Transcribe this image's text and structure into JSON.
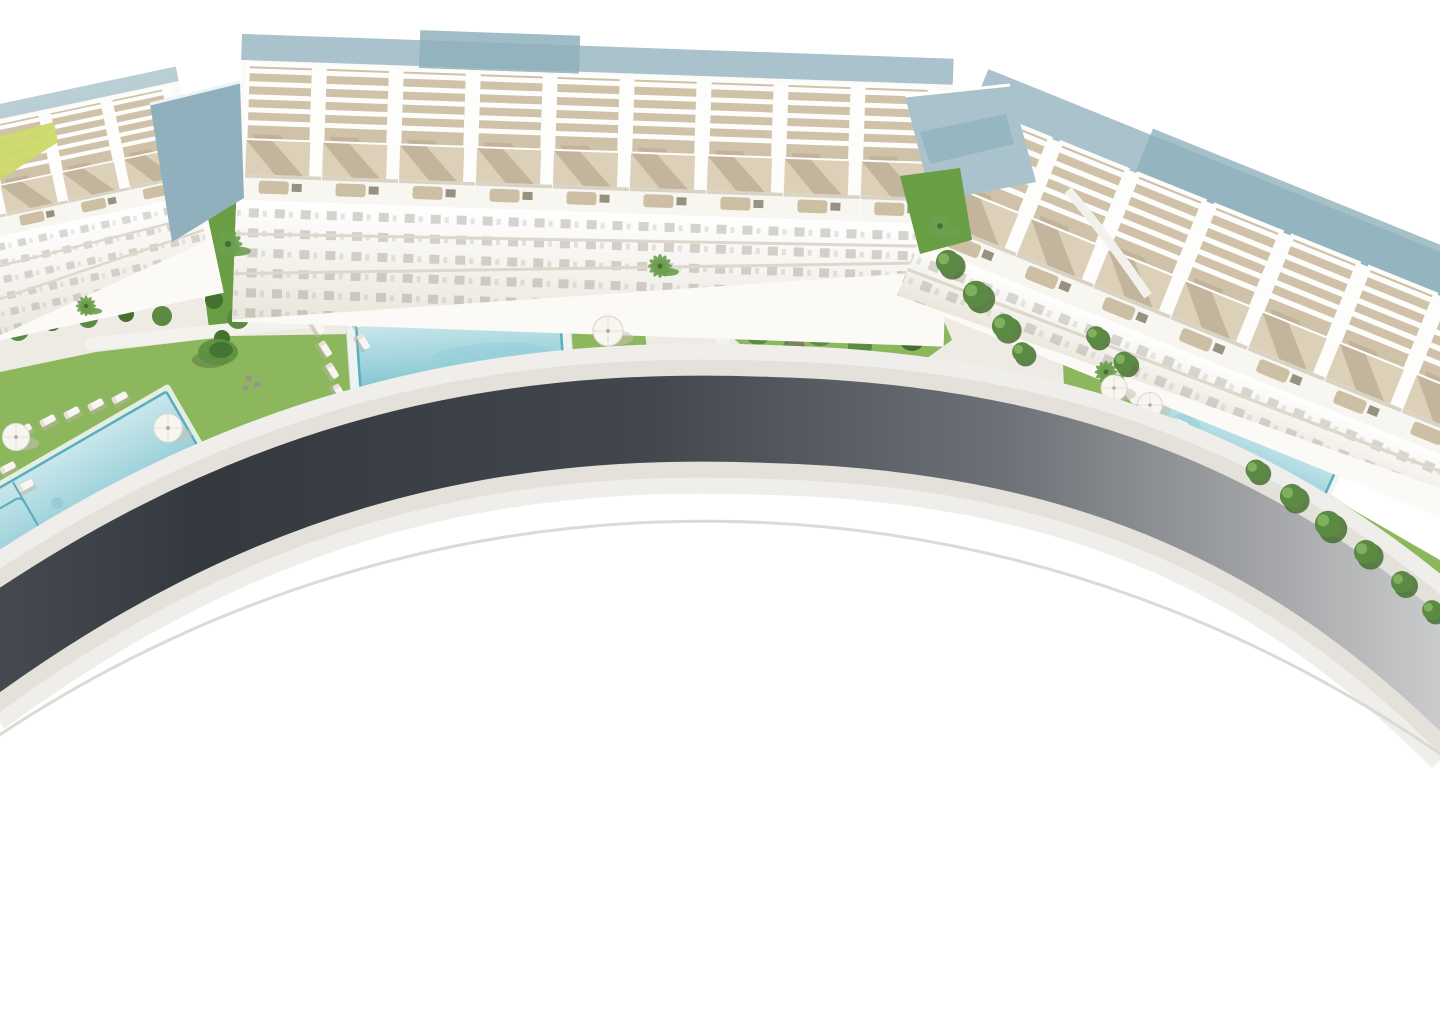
{
  "scene": {
    "type": "aerial_architectural_render",
    "subject": "Bird's-eye 3D render of a curved white residential complex: three townhouse blocks with rooftop pergola terraces, landscaped gardens with three turquoise pools, palm trees, umbrellas and sun loungers, wrapped by a sweeping dark asphalt ring road on an overexposed white ground",
    "background": "#ffffff",
    "visible_text": [],
    "colors": {
      "sky": "#ffffff",
      "building-slab": "#fbfaf7",
      "pergola-white": "#fdfdfb",
      "balcony-white": "#f8f6f1",
      "terrace-floor": "#ddd0b8",
      "terrace-floor-dark": "#cfc2a8",
      "terrace-shadow": "#b1a389",
      "window-dark": "#8e8a80",
      "furniture-beige": "#cdbfa4",
      "furniture-gray": "#97917f",
      "roof-blue-gray": "#a9c2cb",
      "roof-blue-gray-deep": "#8fb0bc",
      "ground-apron": "#edebe4",
      "path-light": "#f4f2ec",
      "lawn-green": "#8cb75d",
      "lawn-green-deep": "#699e45",
      "hedge-green": "#5b8a42",
      "tree-green-dark": "#45702f",
      "palm-green": "#6da04f",
      "lime-planter": "#ccd96a",
      "pool-deck": "#eef3f2",
      "pool-water": "#b3dde4",
      "pool-water-deep": "#7fc3d0",
      "pool-rim": "#58aebe",
      "umbrella-white": "#f8f6f1",
      "road-asphalt-dark": "#353a41",
      "road-asphalt": "#4b5158",
      "road-asphalt-light": "#c2c4c6",
      "sidewalk": "#e3e1da",
      "sidewalk-soft": "#f0eeea",
      "curve-faint": "#dcdad5",
      "shadow-gray": "#c6c1b5"
    },
    "buildings": {
      "left_block": {
        "label": "apartment-block-left",
        "units_visible": 4,
        "tilt_deg": -12,
        "cut_by_frame": true
      },
      "center_block": {
        "label": "apartment-block-center",
        "units_visible": 9,
        "tilt_deg": 2
      },
      "right_block": {
        "label": "apartment-block-right",
        "units_visible": 7,
        "tilt_deg": 22,
        "cut_by_frame": true
      },
      "features": [
        "rooftop pergolas with slatted shade frames",
        "tan terrace floors with diagonal sun shadows",
        "balcony rows with outdoor furniture",
        "lower floors with dark window bands",
        "blue-gray flat roof planes"
      ]
    },
    "amenities": {
      "pools": [
        {
          "label": "lap-pool-left",
          "cut_by_frame": true,
          "has_lane_markings": true
        },
        {
          "label": "main-pool-center",
          "cut_by_frame": false
        },
        {
          "label": "lap-pool-right",
          "cut_by_frame": false,
          "has_tree_shadows": true
        }
      ],
      "umbrella_count": 5,
      "sun_lounger_count": 16,
      "palm_tree_count": 5,
      "round_lawn_tree_count": 1,
      "hedge_clusters": 6,
      "walkways": 3,
      "driveway_ramp": 1
    },
    "road": {
      "label": "ring-road",
      "surface": "asphalt",
      "shape": "wide arc sweeping from lower-left edge around the complex to lower-right edge",
      "sidewalks": "pale concrete bands on both sides",
      "secondary_feature": "faint concentric curve line below the road"
    }
  }
}
